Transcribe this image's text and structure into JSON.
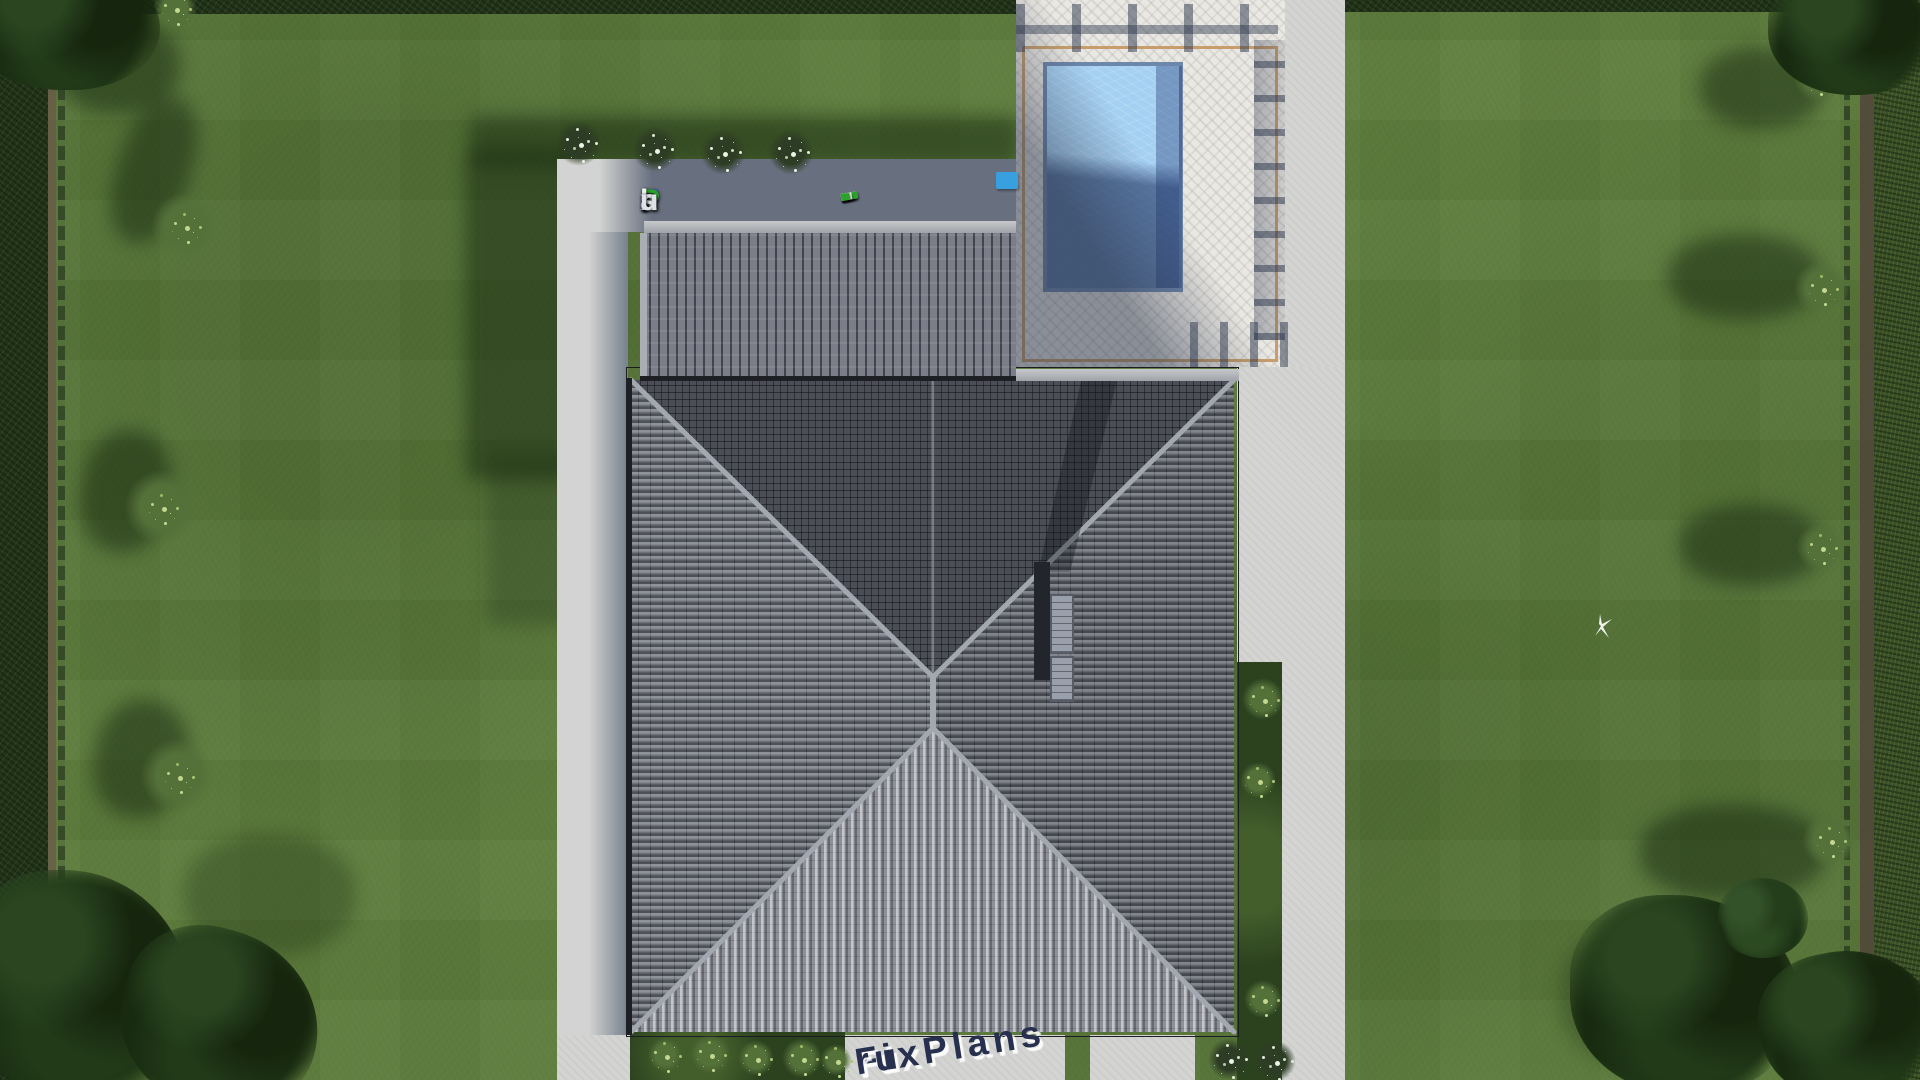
{
  "scene": {
    "type": "aerial-architectural-render",
    "description": "Top-down 3D render of a house with dark hip roof, attached garage wing, travertine pool terrace with pergola shadow, concrete walkways, lawn, hedges and trees",
    "brand": "FixPlans.ru"
  },
  "watermarks": {
    "top": {
      "text": "FixPlans.ru",
      "letters": [
        {
          "ch": "F",
          "color": "#2f62d8"
        },
        {
          "ch": "i",
          "color": "#eef0f2"
        },
        {
          "ch": "x",
          "color": "#eef0f2"
        },
        {
          "ch": "P",
          "color": "#2ba32b"
        },
        {
          "ch": "l",
          "color": "#eef0f2"
        },
        {
          "ch": "a",
          "color": "#eef0f2"
        },
        {
          "ch": "n",
          "color": "#eef0f2"
        },
        {
          "ch": "s",
          "color": "#eef0f2"
        },
        {
          "ch": ".",
          "color": "#2f62d8"
        },
        {
          "ch": "r",
          "color": "#dfe3e8"
        },
        {
          "ch": "u",
          "color": "#dfe3e8"
        }
      ]
    },
    "bottom": {
      "text": "FixPlans.ru",
      "parts": [
        {
          "t": "FixPlans",
          "color": "#27304f"
        },
        {
          "t": ".",
          "color": "#2ea6e0"
        },
        {
          "t": "ru",
          "color": "#27304f"
        }
      ]
    },
    "dash_line": {
      "colors": [
        "#e8e8e8",
        "#e8e8e8",
        "#2f62d8",
        "#e8e8e8",
        "#e8e8e8",
        "#e8e8e8",
        "#e8e8e8",
        "#2ba32b",
        "#e8e8e8",
        "#2ba32b"
      ],
      "end_cap_color": "#39a0e0"
    }
  },
  "palette": {
    "lawn": "#5d7c3c",
    "lawn_shadow": "#203a16",
    "hedge": "#22351a",
    "concrete": "#d4d5d2",
    "concrete_shadow": "#79828f",
    "deck": "#eae8e3",
    "deck_border": "#c79e6b",
    "pool_water_light": "#a5d0f2",
    "pool_water_dark": "#3c5f9e",
    "roof_dark": "#4b4e56",
    "roof_light_face": "#8d9099",
    "garage_roof": "#7b7e88",
    "ridge": "#a3a8b0"
  },
  "features": [
    "hip-roof-house",
    "garage-wing-roof",
    "chimney",
    "two-skylights",
    "swimming-pool",
    "pool-terrace",
    "pergola-shadow",
    "concrete-walkways",
    "lawn",
    "perimeter-hedges",
    "ornamental-bushes",
    "corner-tree-canopies",
    "white-bird"
  ]
}
